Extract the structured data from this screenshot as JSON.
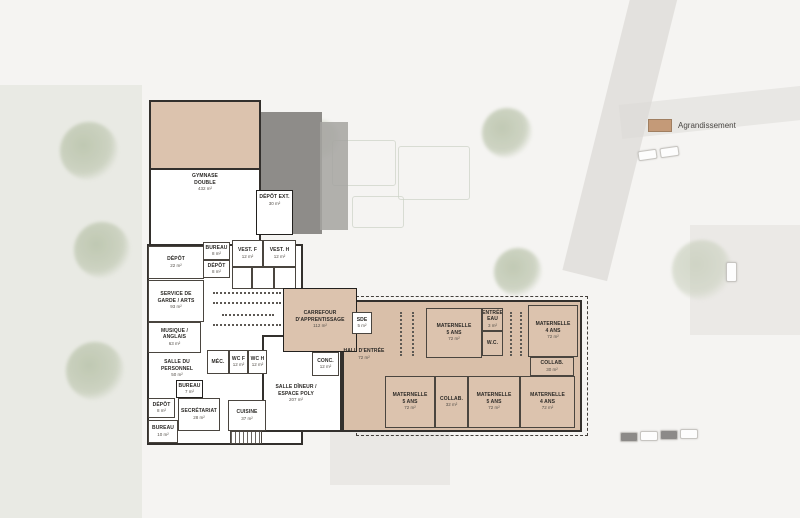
{
  "legend": {
    "label": "Agrandissement",
    "swatch_color": "#c49a78"
  },
  "rooms": {
    "gymnase": {
      "label": "GYMNASE\nDOUBLE",
      "area": "432 m²"
    },
    "depot_ext": {
      "label": "DÉPÔT EXT.",
      "area": "30 m²"
    },
    "depot_22": {
      "label": "DÉPÔT",
      "area": "22 m²"
    },
    "bureau_8": {
      "label": "BUREAU",
      "area": "8 m²"
    },
    "depot_8a": {
      "label": "DÉPÔT",
      "area": "8 m²"
    },
    "vest_f": {
      "label": "VEST. F",
      "area": "12 m²"
    },
    "vest_h": {
      "label": "VEST. H",
      "area": "12 m²"
    },
    "service_garde": {
      "label": "SERVICE DE\nGARDE / ARTS",
      "area": "93 m²"
    },
    "musique": {
      "label": "MUSIQUE /\nANGLAIS",
      "area": "63 m²"
    },
    "salle_personnel": {
      "label": "SALLE DU\nPERSONNEL",
      "area": "50 m²"
    },
    "bureau_7": {
      "label": "BUREAU",
      "area": "7 m²"
    },
    "mec": {
      "label": "MÉC.",
      "area": ""
    },
    "wc_f": {
      "label": "WC F",
      "area": "12 m²"
    },
    "wc_h": {
      "label": "WC H",
      "area": "12 m²"
    },
    "depot_8b": {
      "label": "DÉPÔT",
      "area": "8 m²"
    },
    "secretariat": {
      "label": "SECRÉTARIAT",
      "area": "28 m²"
    },
    "bureau_10": {
      "label": "BUREAU",
      "area": "10 m²"
    },
    "cuisine": {
      "label": "CUISINE",
      "area": "37 m²"
    },
    "conc": {
      "label": "CONC.",
      "area": "12 m²"
    },
    "salle_dineur": {
      "label": "SALLE DÎNEUR /\nESPACE POLY",
      "area": "207 m²"
    },
    "carrefour": {
      "label": "CARREFOUR\nD'APPRENTISSAGE",
      "area": "112 m²"
    },
    "sde": {
      "label": "SDE",
      "area": "5 m²"
    },
    "hall": {
      "label": "HALL D'ENTRÉE",
      "area": "72 m²"
    },
    "entree_eau": {
      "label": "ENTRÉE\nEAU",
      "area": "3 m²"
    },
    "wc_small": {
      "label": "W.C.",
      "area": ""
    },
    "mat5_a": {
      "label": "MATERNELLE\n5 ANS",
      "area": "72 m²"
    },
    "mat4_a": {
      "label": "MATERNELLE\n4 ANS",
      "area": "72 m²"
    },
    "collab_30": {
      "label": "COLLAB.",
      "area": "30 m²"
    },
    "mat5_b": {
      "label": "MATERNELLE\n5 ANS",
      "area": "72 m²"
    },
    "collab_32": {
      "label": "COLLAB.",
      "area": "32 m²"
    },
    "mat5_c": {
      "label": "MATERNELLE\n5 ANS",
      "area": "72 m²"
    },
    "mat4_b": {
      "label": "MATERNELLE\n4 ANS",
      "area": "72 m²"
    }
  }
}
